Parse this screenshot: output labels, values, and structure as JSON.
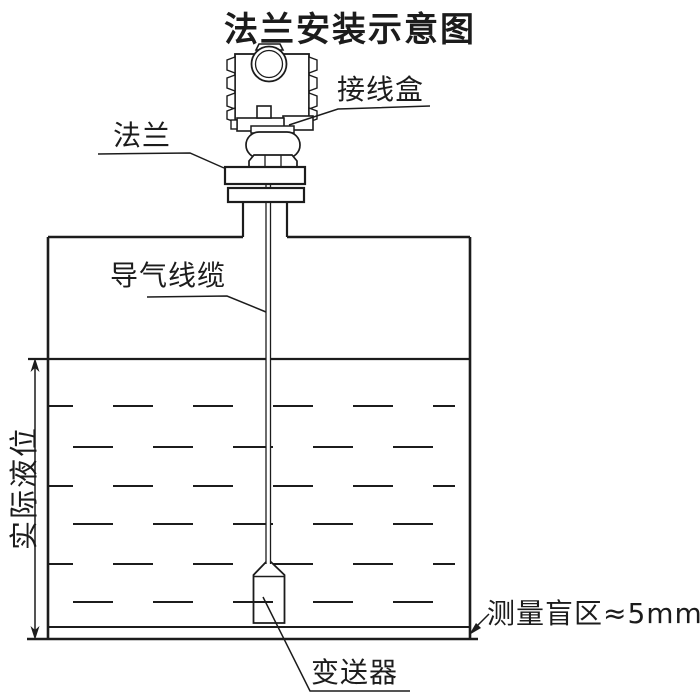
{
  "title": "法兰安装示意图",
  "labels": {
    "junction_box": "接线盒",
    "flange": "法兰",
    "air_cable": "导气线缆",
    "actual_level": "实际液位",
    "transmitter": "变送器",
    "blind_zone": "测量盲区≈5mm"
  },
  "colors": {
    "line": "#1c1c1c",
    "background": "#ffffff"
  }
}
